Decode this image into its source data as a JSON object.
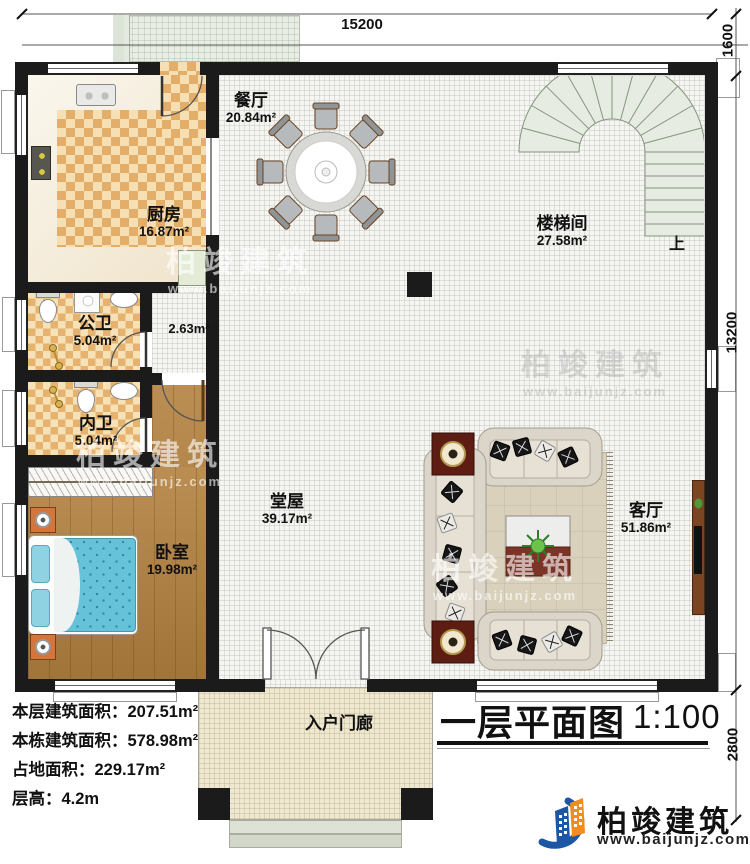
{
  "plan": {
    "dimensions": {
      "top": "15200",
      "right_top": "1600",
      "right_side": "13200",
      "right_bottom": "2800"
    },
    "rooms": {
      "dining": {
        "name": "餐厅",
        "area": "20.84m²"
      },
      "kitchen": {
        "name": "厨房",
        "area": "16.87m²"
      },
      "stairwell": {
        "name": "楼梯间",
        "area": "27.58m²"
      },
      "public_bath": {
        "name": "公卫",
        "area": "5.04m²"
      },
      "inner_bath": {
        "name": "内卫",
        "area": "5.04m²"
      },
      "bedroom": {
        "name": "卧室",
        "area": "19.98m²"
      },
      "hall": {
        "name": "堂屋",
        "area": "39.17m²"
      },
      "living": {
        "name": "客厅",
        "area": "51.86m²"
      },
      "porch": {
        "name": "入户门廊"
      },
      "corridor": {
        "area": "2.63m²"
      },
      "stairs_up": "上"
    }
  },
  "info_panel": {
    "lines": [
      {
        "label": "本层建筑面积：",
        "value": "207.51m²"
      },
      {
        "label": "本栋建筑面积：",
        "value": "578.98m²"
      },
      {
        "label": "占地面积：",
        "value": "229.17m²"
      },
      {
        "label": "层高：",
        "value": "4.2m"
      }
    ]
  },
  "title_block": {
    "title": "一层平面图",
    "scale": "1:100"
  },
  "brand": {
    "name": "柏竣建筑",
    "url": "www.baijunjz.com"
  },
  "watermark": {
    "name": "柏竣建筑",
    "url": "www.baijunjz.com"
  },
  "colors": {
    "wall": "#1b1b1b",
    "checker_dark": "#e2ae6a",
    "checker_light": "#f6dfb3",
    "wood_floor": "#b3813f",
    "bed_blue": "#66c2d9",
    "stair_tread": "#e6ece2",
    "logo_blue": "#1c57a5",
    "logo_orange": "#f28c1e",
    "side_table_red": "#5e1d12"
  }
}
